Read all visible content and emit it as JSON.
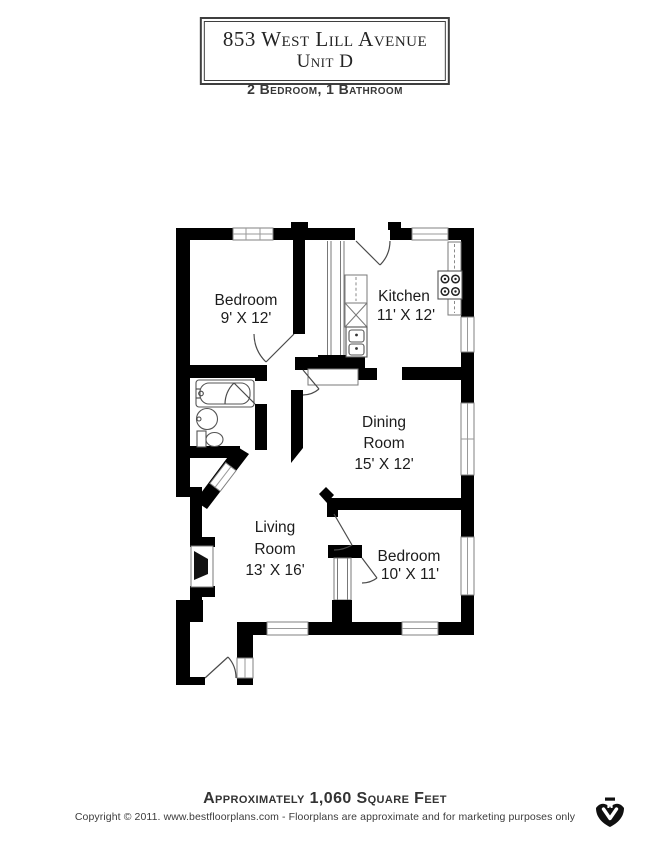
{
  "header": {
    "address_line1": "853 West Lill Avenue",
    "address_line2": "Unit D",
    "subtitle": "2 Bedroom, 1 Bathroom"
  },
  "rooms": {
    "bedroom1": {
      "name": "Bedroom",
      "dims": "9' X 12'"
    },
    "kitchen": {
      "name": "Kitchen",
      "dims": "11' X 12'"
    },
    "dining": {
      "name_line1": "Dining",
      "name_line2": "Room",
      "dims": "15' X 12'"
    },
    "living": {
      "name_line1": "Living",
      "name_line2": "Room",
      "dims": "13' X 16'"
    },
    "bedroom2": {
      "name": "Bedroom",
      "dims": "10' X 11'"
    }
  },
  "footer": {
    "area_text": "Approximately 1,060 Square Feet",
    "copyright": "Copyright © 2011. www.bestfloorplans.com - Floorplans are approximate and for marketing purposes only"
  },
  "colors": {
    "wall": "#000000",
    "fixture": "#787878",
    "label": "#1c1c1c",
    "page_bg": "#ffffff"
  }
}
